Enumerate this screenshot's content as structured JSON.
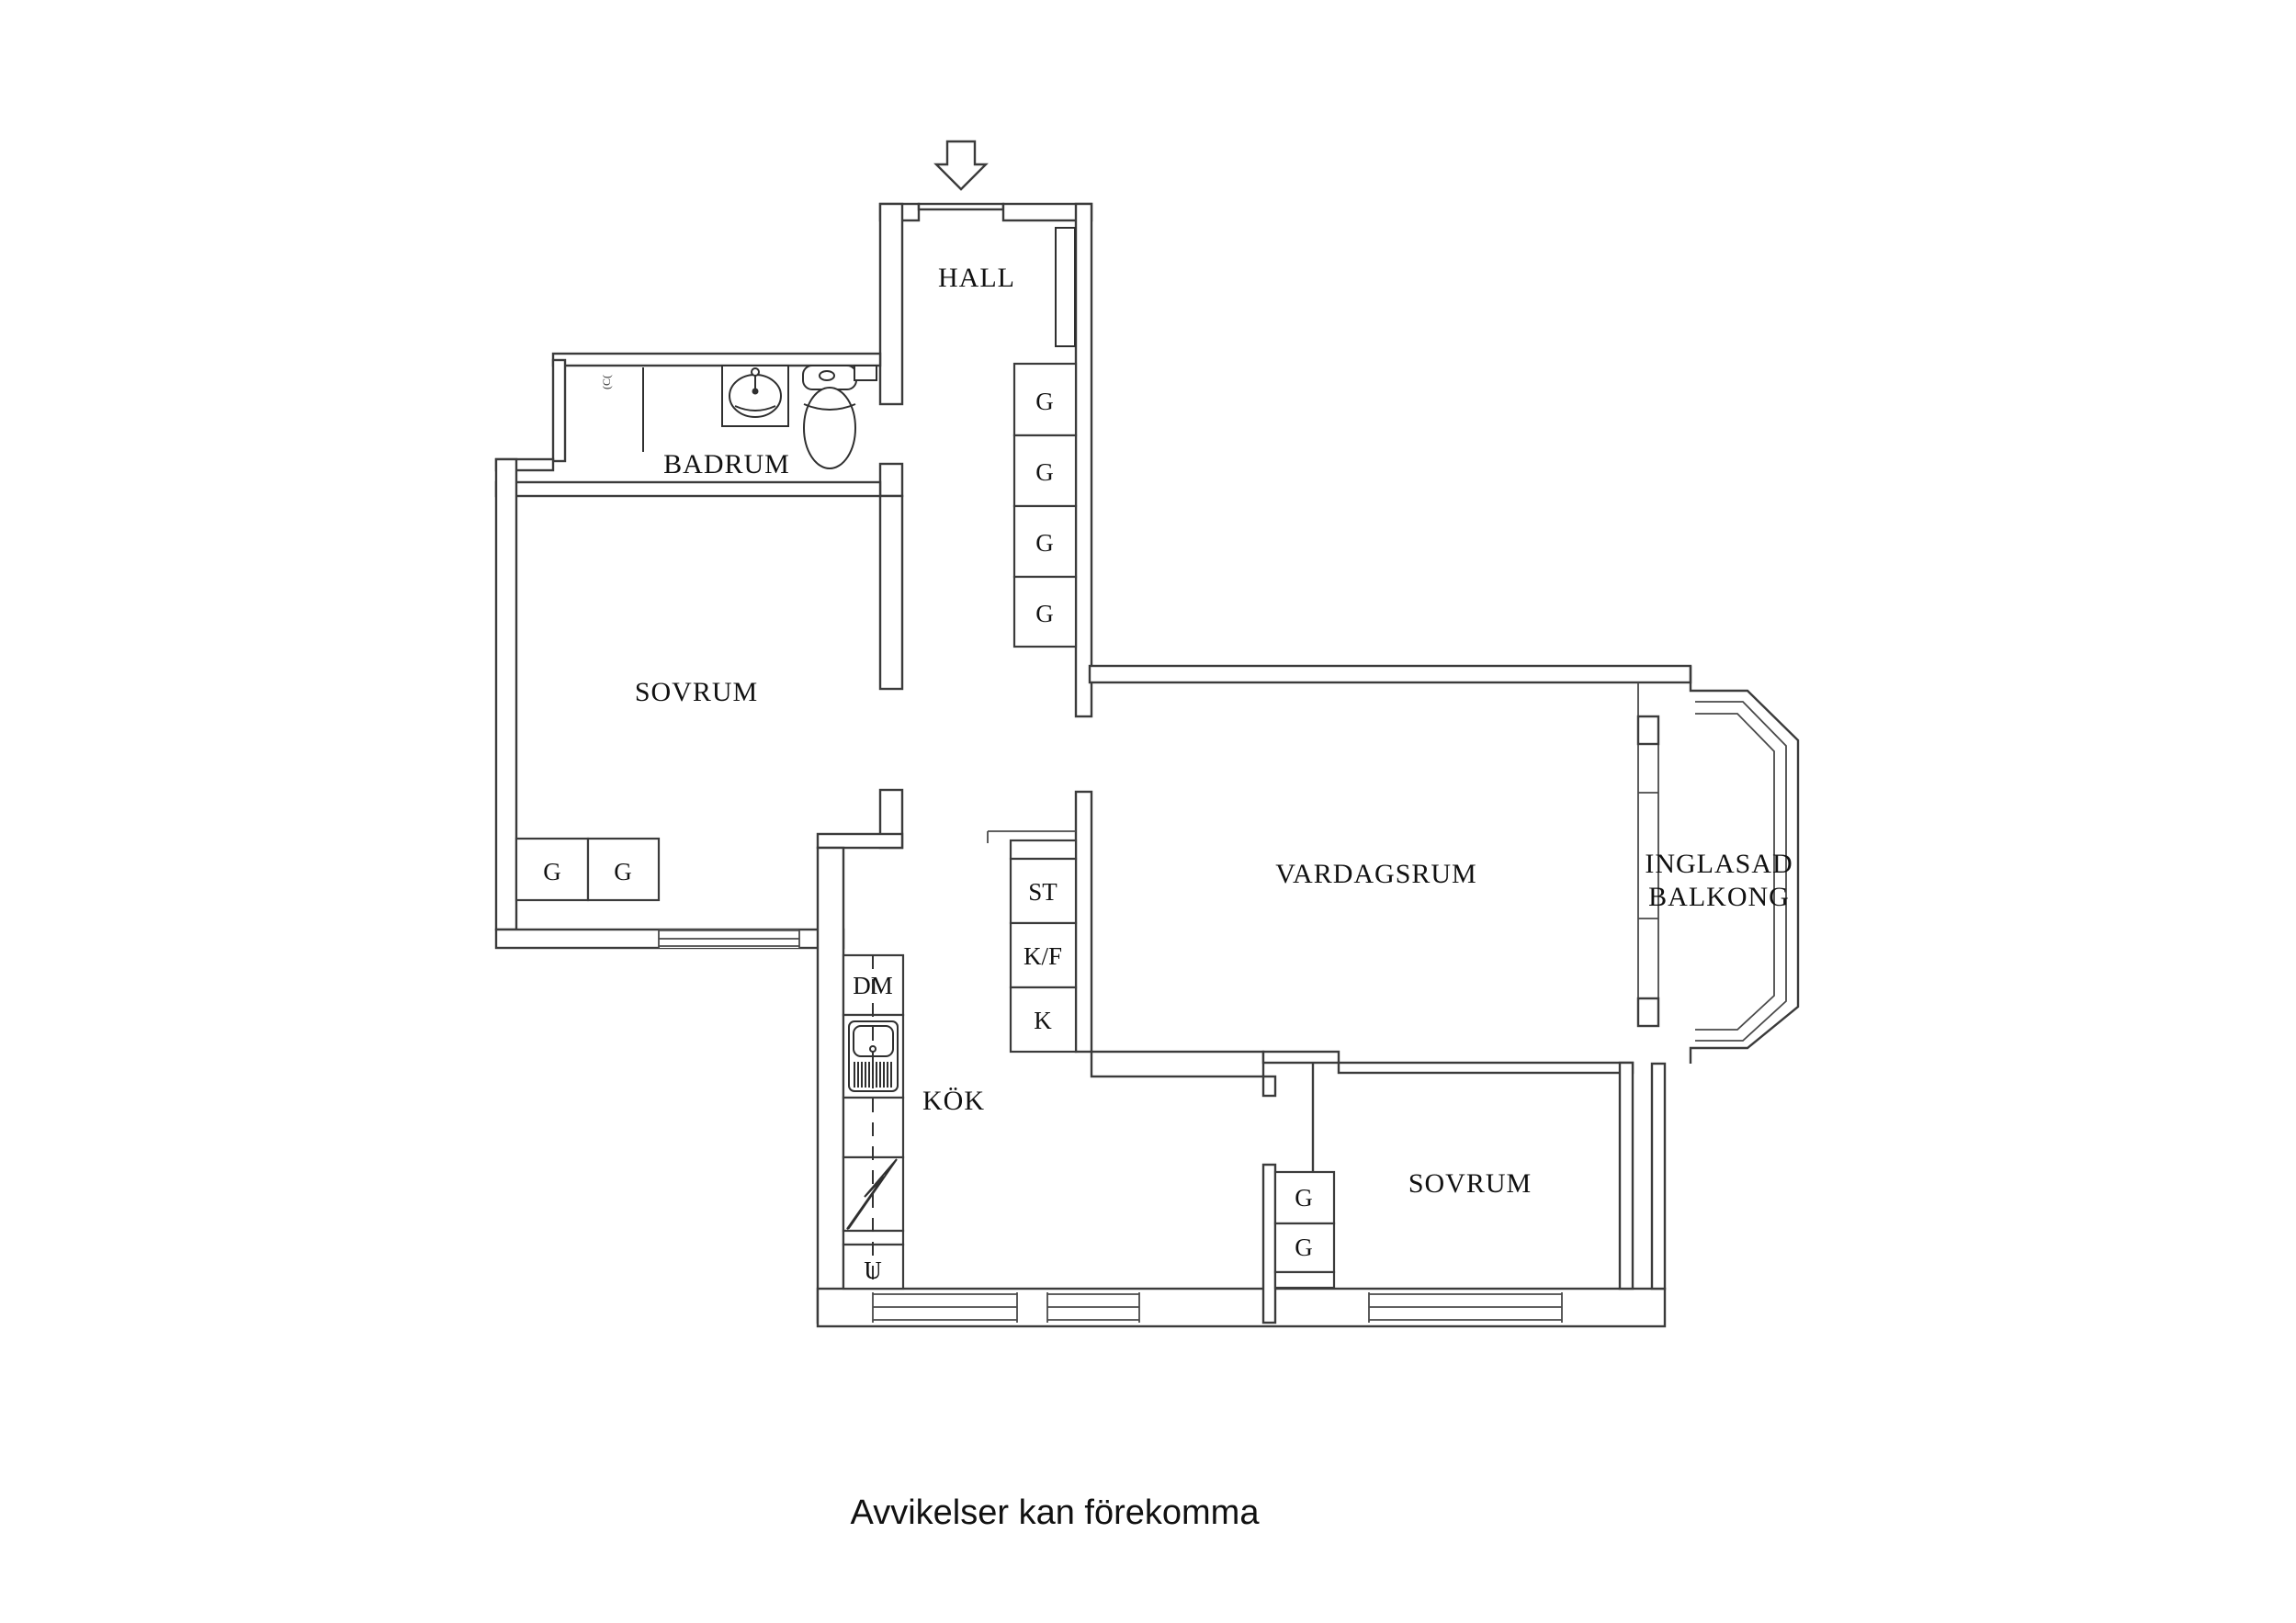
{
  "rooms": {
    "hall": "HALL",
    "bathroom": "BADRUM",
    "bedroom1": "SOVRUM",
    "living": "VARDAGSRUM",
    "kitchen": "KÖK",
    "bedroom2": "SOVRUM",
    "balcony_line1": "INGLASAD",
    "balcony_line2": "BALKONG"
  },
  "closets": {
    "hall": [
      "G",
      "G",
      "G",
      "G"
    ],
    "bedroom1": [
      "G",
      "G"
    ],
    "bedroom2": [
      "G",
      "G"
    ]
  },
  "kitchen_units": {
    "dishwasher": "DM",
    "tall": [
      "ST",
      "K/F",
      "K"
    ],
    "oven_mark": "U"
  },
  "bathroom_mark": "(C(",
  "footer": {
    "note": "Avvikelser kan förekomma"
  },
  "colors": {
    "line": "#3b3b3b",
    "text": "#111111",
    "background": "#ffffff"
  }
}
